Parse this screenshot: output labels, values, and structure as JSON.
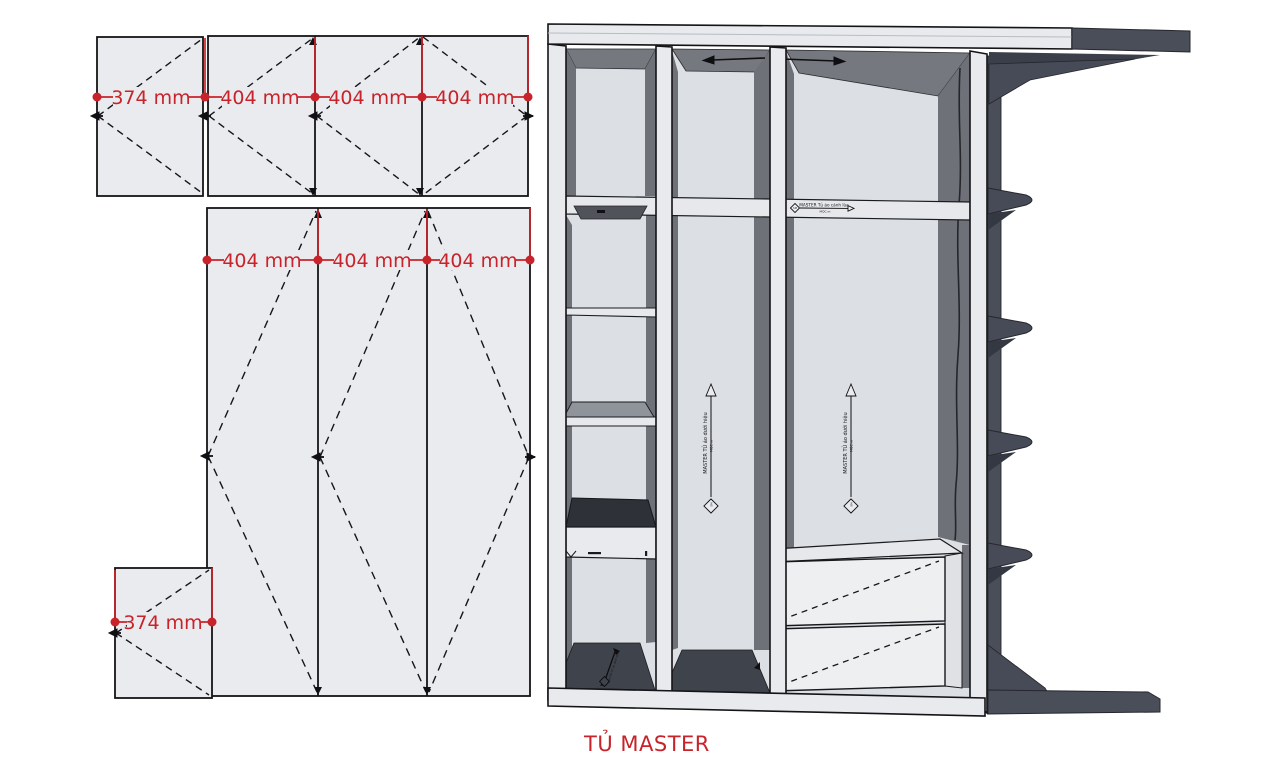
{
  "title": "TỦ MASTER",
  "flat_panels": {
    "top_row_dims": [
      "374 mm",
      "404 mm",
      "404 mm",
      "404 mm"
    ],
    "middle_row_dims": [
      "404 mm",
      "404 mm",
      "404 mm"
    ],
    "bottom_panel_dim": "374 mm"
  },
  "wardrobe": {
    "rail_label": "MASTER Tủ áo cánh lùa",
    "rail_sublabel": "MỘC m",
    "hang_label": "MASTER TỦ áo dưới hiệu",
    "hang_sublabel": "MỘC m",
    "logo_text": "SM"
  },
  "colors": {
    "accent_red": "#c8232a",
    "panel_fill": "#e9ebee",
    "interior_dark": "#75787e",
    "shelf_dark": "#41444c",
    "exterior_slate": "#4a4e59"
  }
}
